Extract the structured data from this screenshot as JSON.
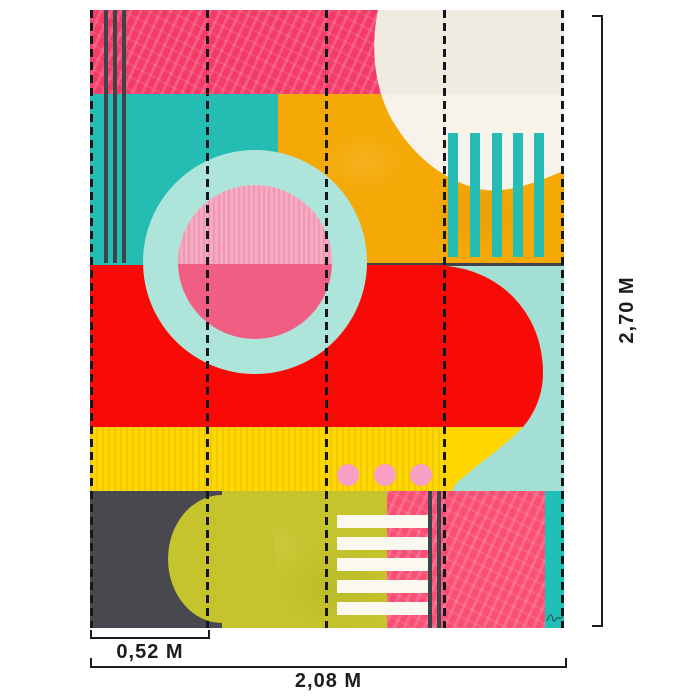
{
  "measurements": {
    "height": "2,70 M",
    "width": "2,08 M",
    "panel_width": "0,52 M"
  },
  "artwork": {
    "panel_count": 4,
    "style": "abstract geometric collage wall mural"
  },
  "palette": {
    "hot_pink": "#F43A67",
    "teal": "#25BDB3",
    "orange": "#F4A906",
    "cream": "#EFEBE0",
    "cream_light": "#F6F3EA",
    "mint": "#AEE5DA",
    "light_pink": "#F7ABC2",
    "rose": "#F15E83",
    "red": "#FA0A06",
    "aqua": "#A4DFD5",
    "yellow": "#FFD600",
    "dot_pink": "#F79FC5",
    "olive": "#C5C42C",
    "dark": "#47494E",
    "line_dark": "#3E434A",
    "bottom_pink": "#FB4E75",
    "teal_strip": "#1FC0B8",
    "stripe_white": "#FBF9EF",
    "seam": "#14171C",
    "measure": "#1C1C1C",
    "signature_col": "#2F5F5C"
  }
}
